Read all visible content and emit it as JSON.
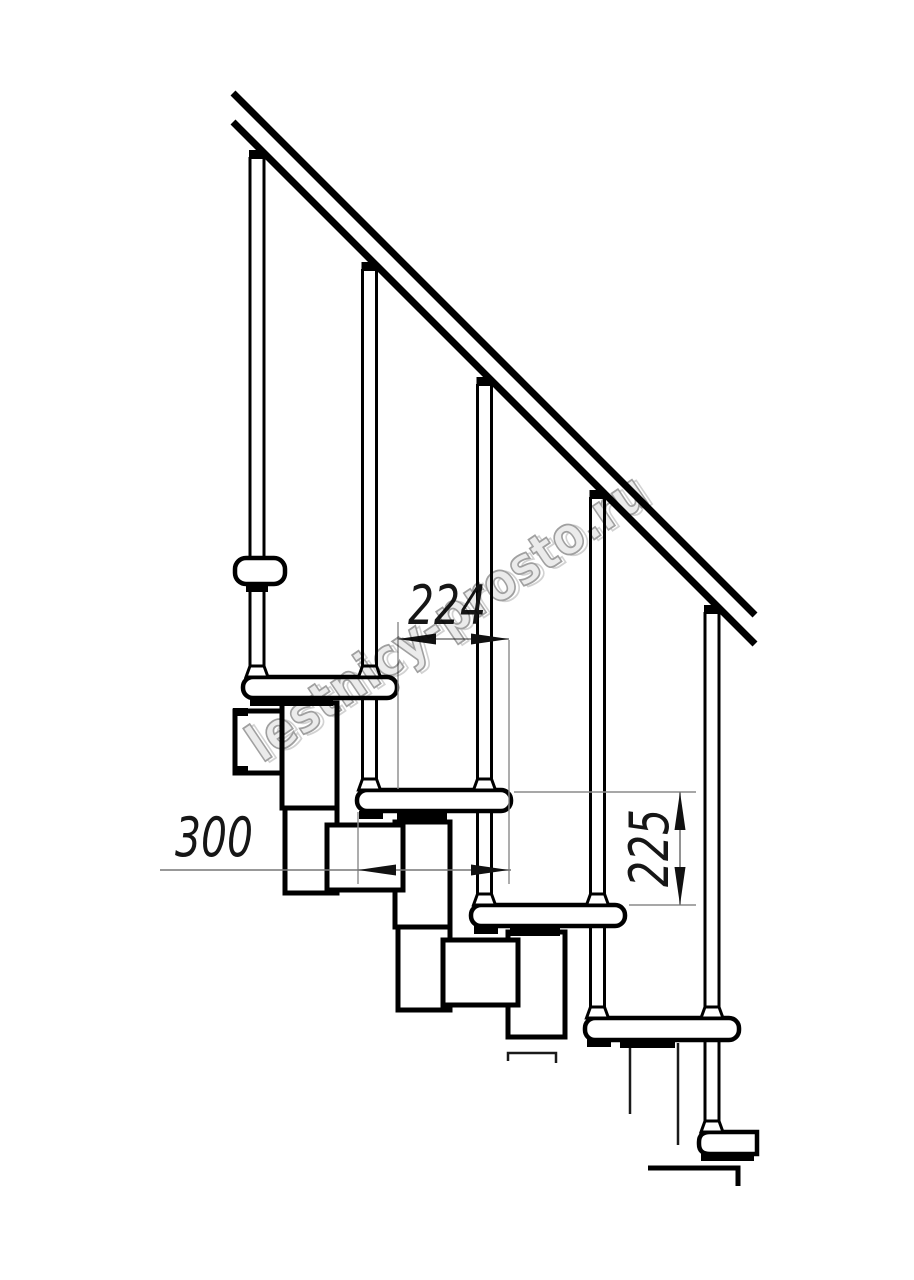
{
  "drawing": {
    "kind": "staircase-side-view-fragment",
    "background_color": "#ffffff",
    "ink_color": "#000000",
    "dimension_line_color": "#777777",
    "dimensions": {
      "going": {
        "label": "224",
        "orientation": "horizontal"
      },
      "tread_depth": {
        "label": "300",
        "orientation": "horizontal"
      },
      "riser_height": {
        "label": "225",
        "orientation": "vertical"
      }
    },
    "watermark": {
      "text": "lestnicy-prosto.ru",
      "fill": "#ebebeb",
      "stroke": "#a0a0a0",
      "angle_deg": -34
    },
    "structure": {
      "handrail_count": 1,
      "baluster_count": 5,
      "tread_count": 5,
      "wall_bracket_count": 1
    }
  }
}
